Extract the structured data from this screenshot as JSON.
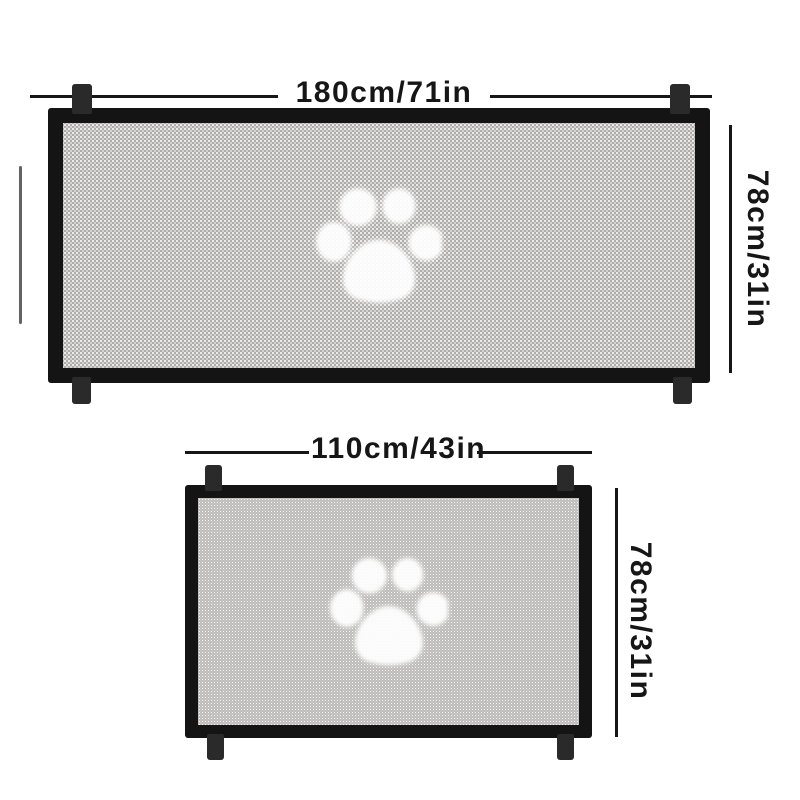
{
  "figures": [
    {
      "name": "large-gate",
      "width_label": "180cm/71in",
      "height_label": "78cm/31in"
    },
    {
      "name": "small-gate",
      "width_label": "110cm/43in",
      "height_label": "78cm/31in"
    }
  ],
  "icons": [
    {
      "name": "paw-print-icon",
      "meaning": "white paw print printed on gate mesh"
    }
  ],
  "colors": {
    "background": "#ffffff",
    "frame": "#141414",
    "tab": "#2a2a2a",
    "dimension": "#161616",
    "mesh_base": "#aeadab",
    "mesh_dot_light": "#f6f5f3",
    "mesh_dot_mid": "#dcdbd9",
    "paw": "#ffffff"
  }
}
